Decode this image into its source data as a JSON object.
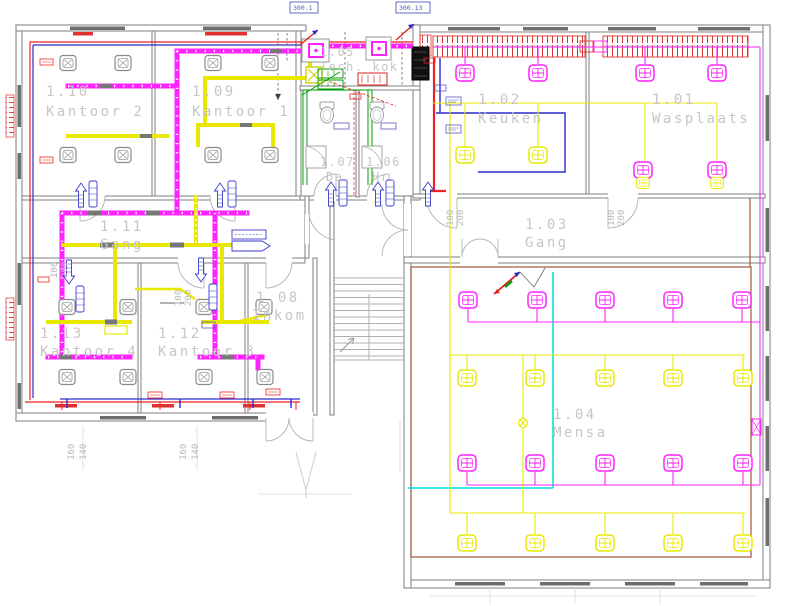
{
  "drawing": {
    "type": "floor-plan",
    "rooms": {
      "r101": {
        "id": "1.01",
        "name": "Wasplaats"
      },
      "r102": {
        "id": "1.02",
        "name": "Keuken"
      },
      "r103": {
        "id": "1.03",
        "name": "Gang"
      },
      "r104": {
        "id": "1.04",
        "name": "Mensa"
      },
      "r105": {
        "id": "1.05",
        "name": "Tech. kok"
      },
      "r106": {
        "id": "1.06",
        "name": "Hr."
      },
      "r107": {
        "id": "1.07",
        "name": "Da."
      },
      "r108": {
        "id": "1.08",
        "name": "Inkom"
      },
      "r109": {
        "id": "1.09",
        "name": "Kantoor 1"
      },
      "r110": {
        "id": "1.10",
        "name": "Kantoor 2"
      },
      "r111": {
        "id": "1.11",
        "name": "Gang"
      },
      "r112": {
        "id": "1.12",
        "name": "Kantoor 3"
      },
      "r113": {
        "id": "1.13",
        "name": "Kantoor 4"
      }
    },
    "ref_tags": {
      "left": "300.1",
      "right": "300.13"
    },
    "dims": {
      "win_a": "160",
      "win_b": "140",
      "door_w": "100",
      "door_h": "200"
    },
    "colors": {
      "duct_supply": "#ff22ff",
      "lighting": "#e8e800",
      "heating_flow": "#ee2222",
      "heating_return": "#2a2acc",
      "sanitary": "#00a000",
      "cold_water": "#00dddd",
      "wall": "#8a8a8a",
      "label": "#c6c6c6"
    }
  }
}
